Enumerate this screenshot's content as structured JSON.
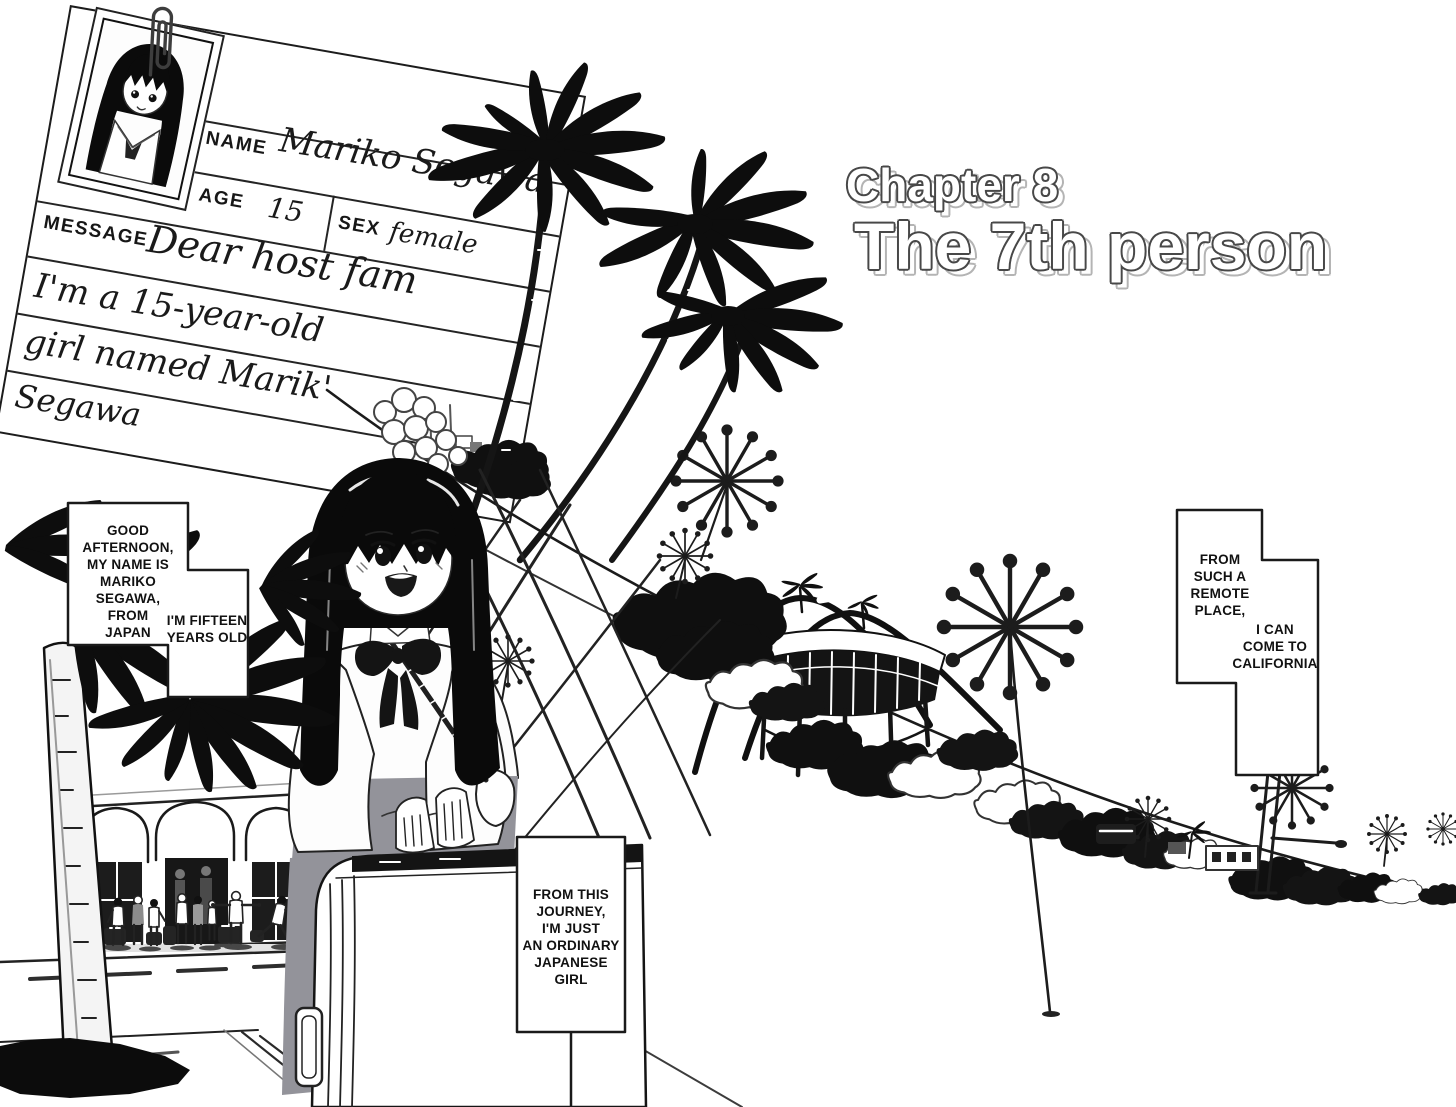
{
  "title": {
    "chapter_label": "Chapter 8",
    "chapter_name": "The 7th person"
  },
  "id_card": {
    "name_label": "NAME",
    "name_value": "Mariko Segawa",
    "age_label": "AGE",
    "age_value": "15",
    "sex_label": "SEX",
    "sex_value": "female",
    "message_label": "MESSAGE",
    "message_line1": "Dear host fam",
    "message_line2": "I'm a 15-year-old",
    "message_line3": "girl named Marik'",
    "message_line4": "Segawa"
  },
  "captions": {
    "greeting": "GOOD\nAFTERNOON,\nMY NAME IS\nMARIKO\nSEGAWA,\nFROM\nJAPAN",
    "age": "I'M FIFTEEN\nYEARS OLD",
    "remote": "FROM\nSUCH A\nREMOTE\nPLACE,",
    "california": "I CAN\nCOME TO\nCALIFORNIA",
    "journey": "FROM THIS\nJOURNEY,\nI'M JUST\nAN ORDINARY\nJAPANESE\nGIRL"
  },
  "colors": {
    "ink": "#141414",
    "paper": "#ffffff",
    "skirt": "#93939a",
    "title_outline": "#484848",
    "title_shadow": "#b4b4b4"
  }
}
